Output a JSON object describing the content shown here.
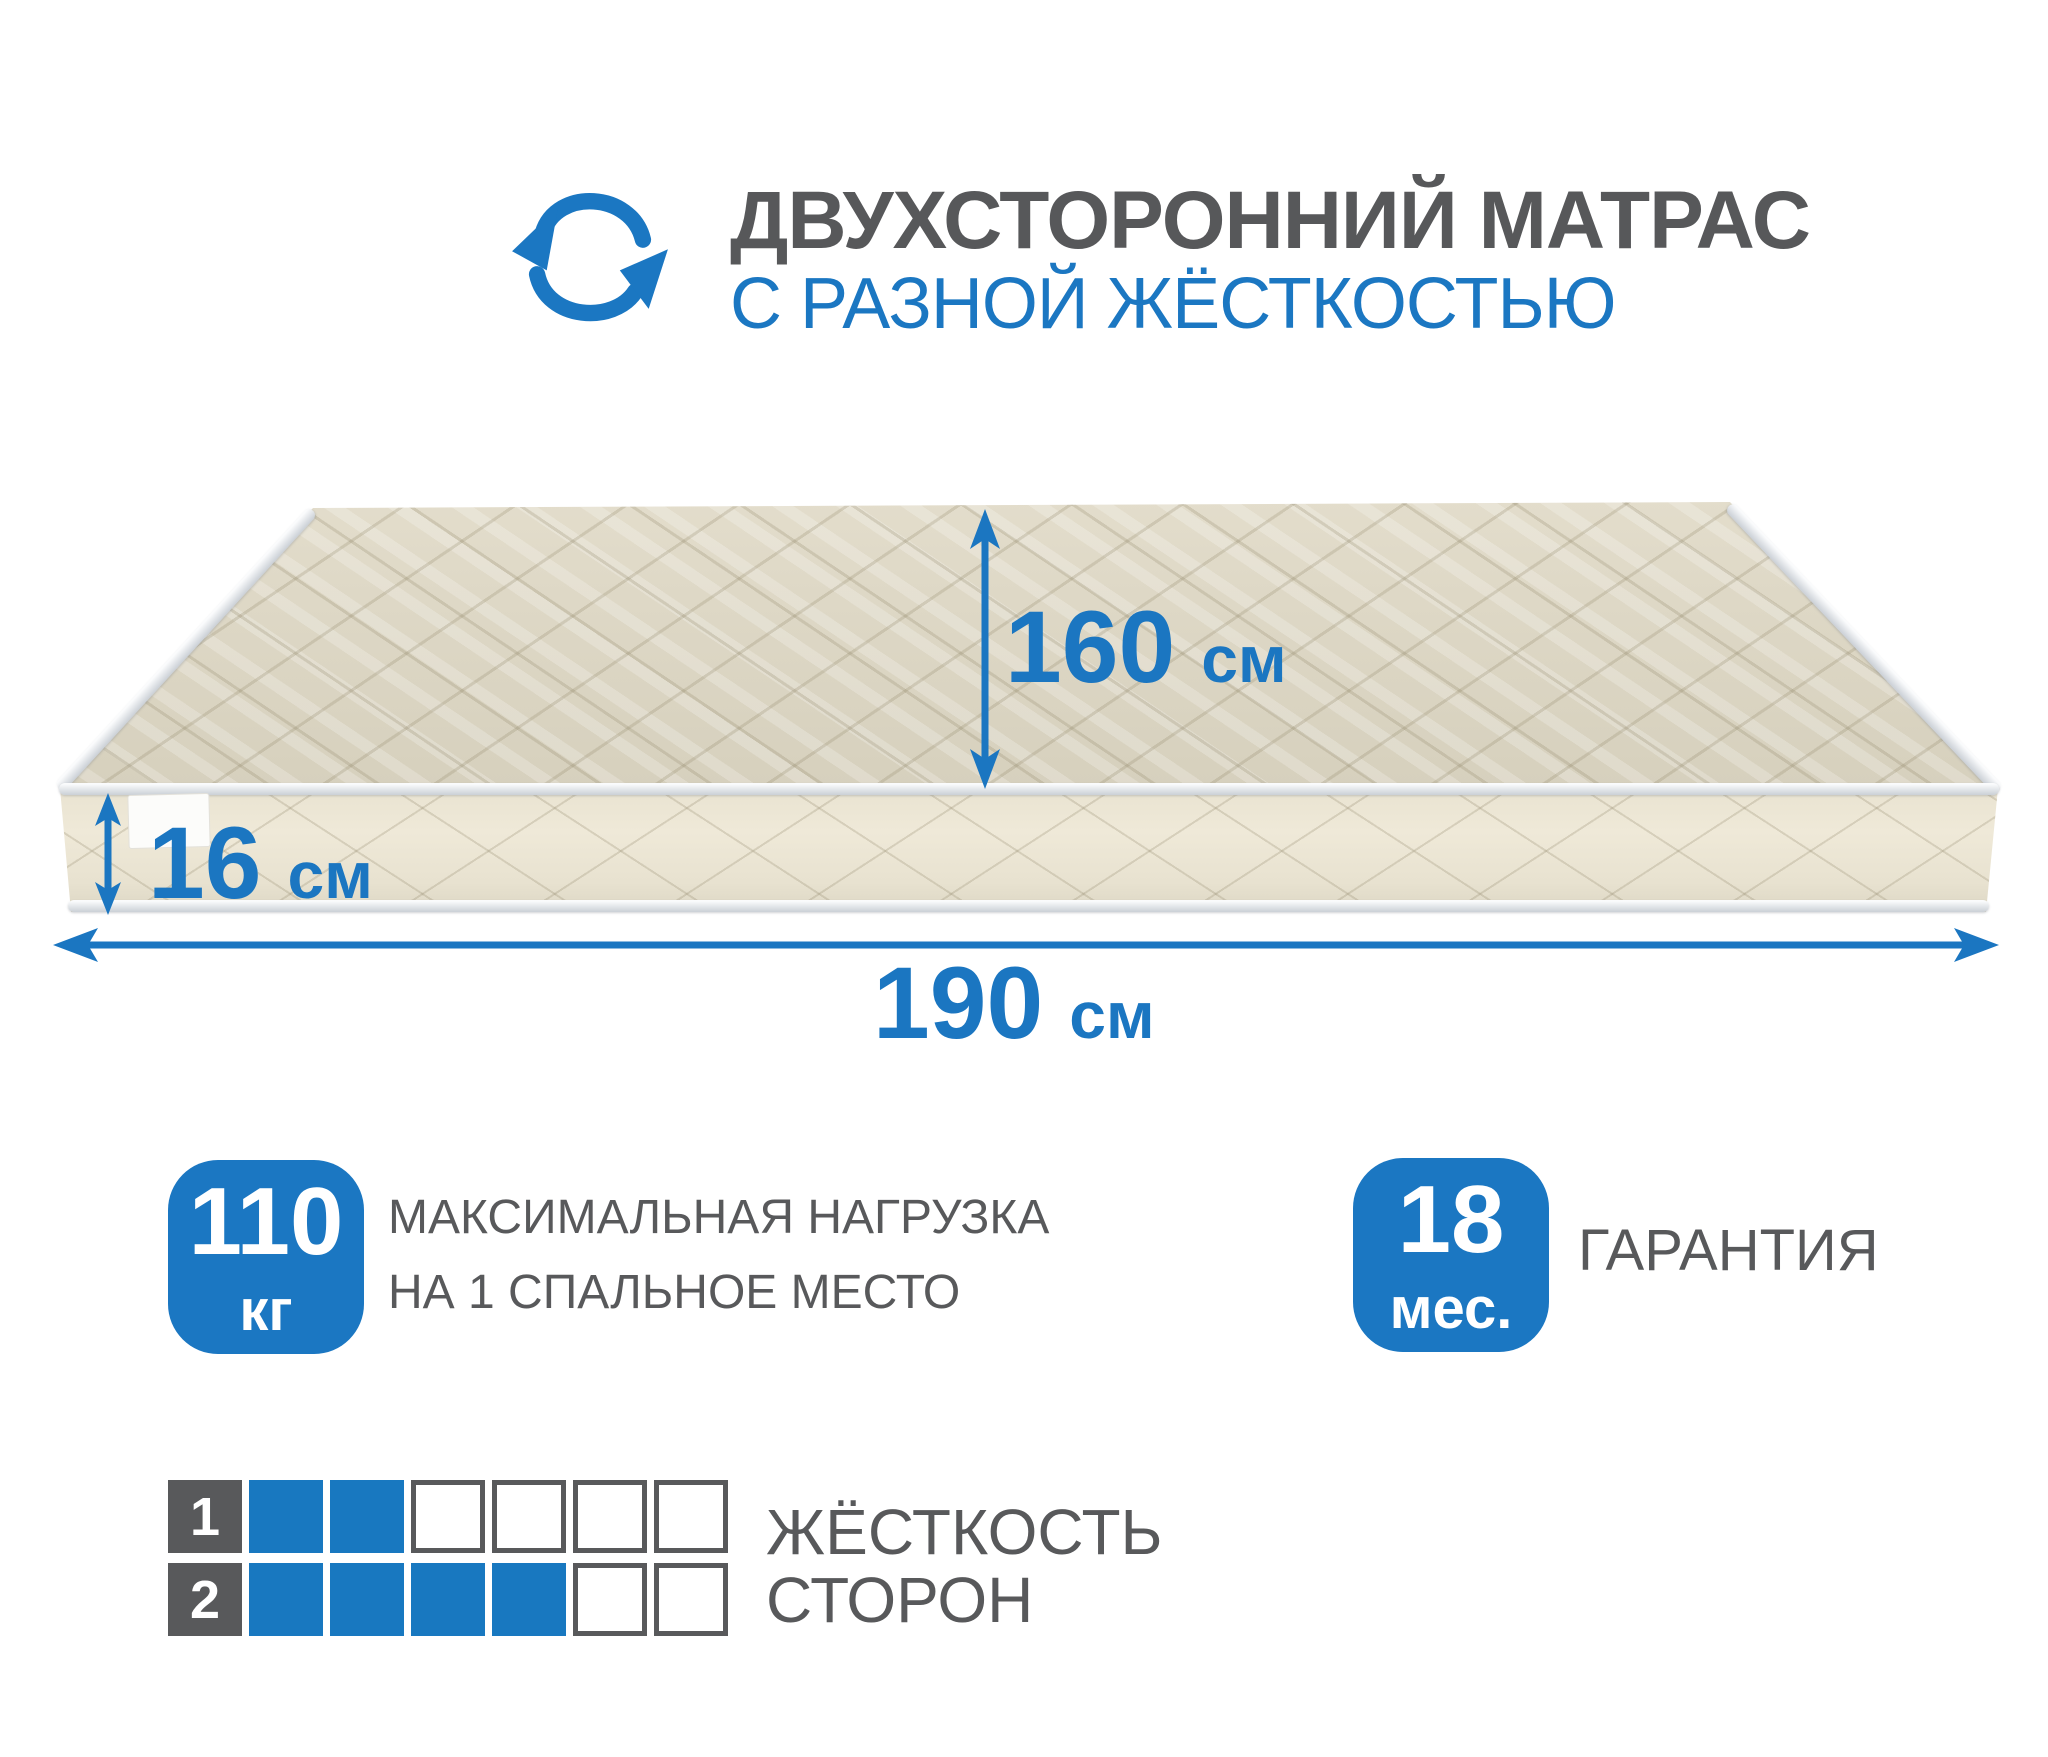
{
  "header": {
    "icon": "rotate-cycle-icon",
    "title": "ДВУХСТОРОННИЙ МАТРАС",
    "subtitle": "С РАЗНОЙ ЖЁСТКОСТЬЮ"
  },
  "mattress": {
    "depth": {
      "value": "160",
      "unit": "см"
    },
    "height": {
      "value": "16",
      "unit": "см"
    },
    "width": {
      "value": "190",
      "unit": "см"
    }
  },
  "badges": {
    "max_load": {
      "value": "110",
      "unit": "кг",
      "line1": "МАКСИМАЛЬНАЯ НАГРУЗКА",
      "line2": "НА 1 СПАЛЬНОЕ МЕСТО"
    },
    "warranty": {
      "value": "18",
      "unit": "мес.",
      "label": "ГАРАНТИЯ"
    }
  },
  "firmness": {
    "line1": "ЖЁСТКОСТЬ",
    "line2": "СТОРОН",
    "scale_max": 6,
    "sides": [
      {
        "side": "1",
        "level": 2
      },
      {
        "side": "2",
        "level": 4
      }
    ]
  },
  "colors": {
    "accent_blue": "#1b77c2",
    "text_gray": "#58595b",
    "mattress_top": "#ded8c6",
    "mattress_side": "#e9e3d1"
  }
}
